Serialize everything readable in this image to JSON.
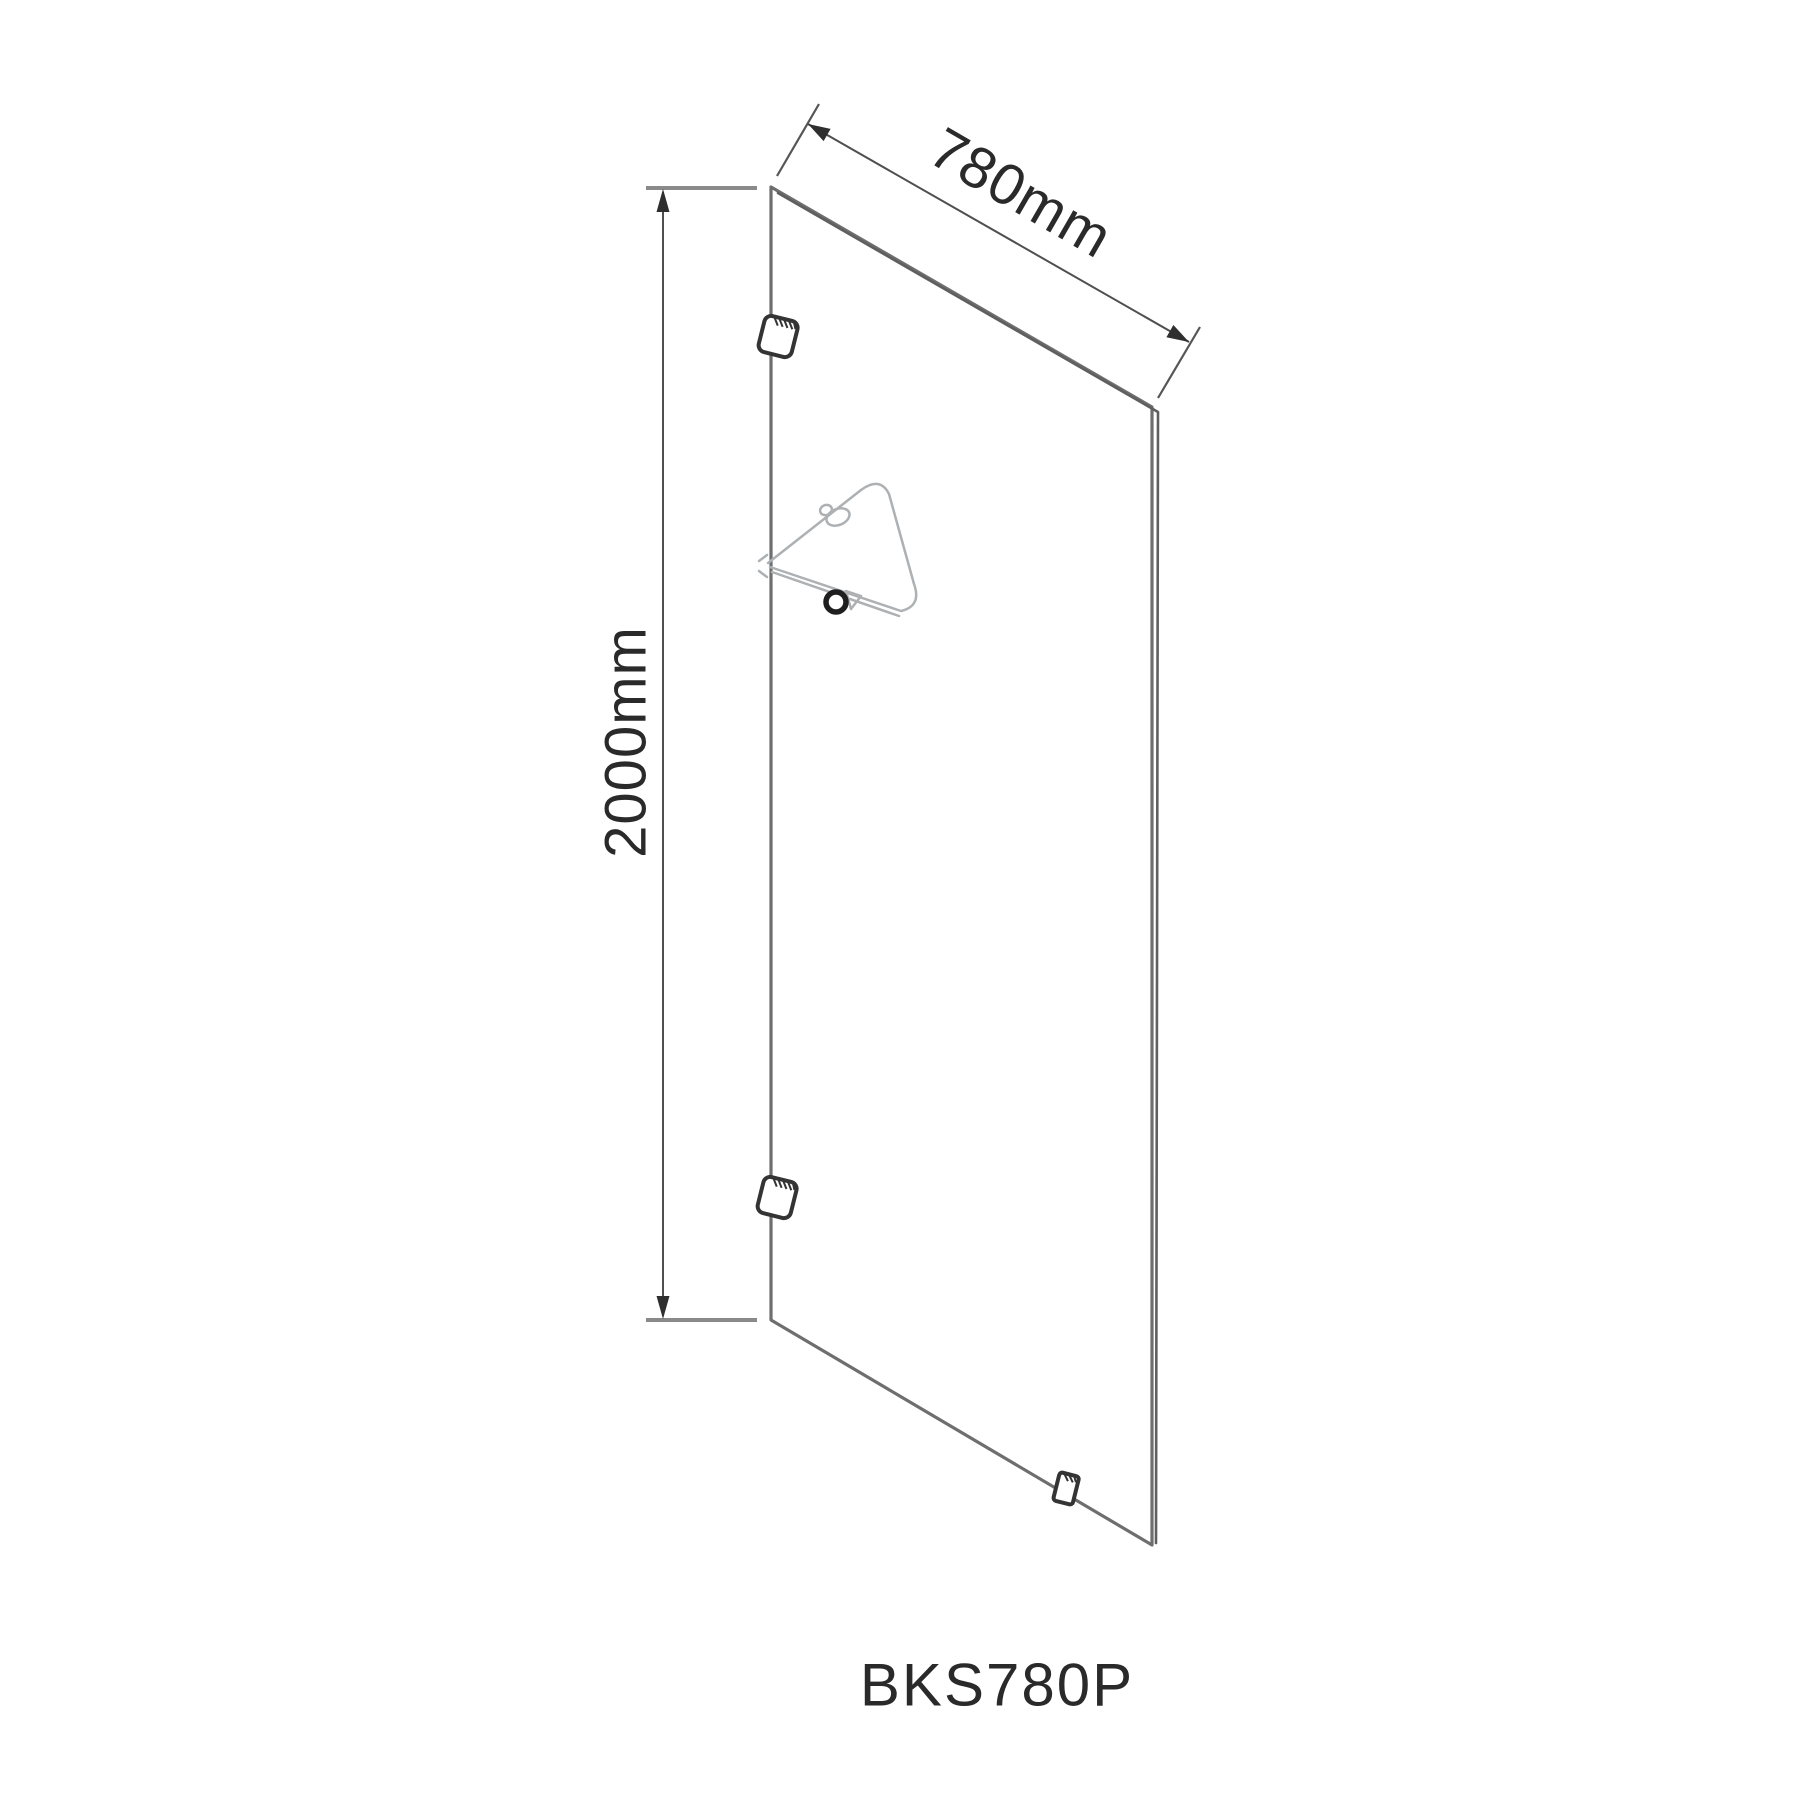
{
  "drawing": {
    "product_code": "BKS780P",
    "width_dimension": {
      "label": "780mm"
    },
    "height_dimension": {
      "label": "2000mm"
    },
    "colors": {
      "background": "#ffffff",
      "panel_stroke": "#6e6e6e",
      "thickness_stroke": "#5f5f5f",
      "dimension_stroke": "#4f4f4f",
      "arrow_fill": "#2f2f2f",
      "extension_stroke": "#8a8a8a",
      "tick_stroke": "#565656",
      "bracket_stroke": "#343434",
      "bracket_fill": "#ffffff",
      "shelf_stroke": "#adb1b3",
      "knob_stroke": "#1f1f1f",
      "text_color": "#2a2a2a"
    }
  }
}
